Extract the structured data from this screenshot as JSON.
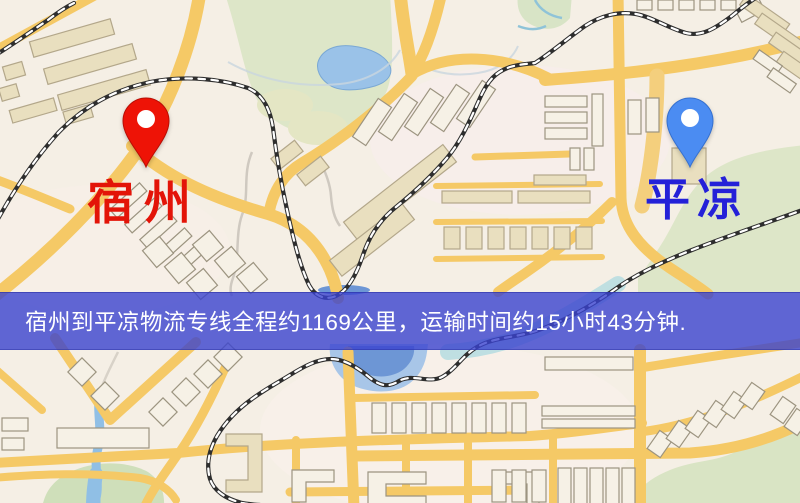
{
  "app": {
    "type": "logistics-route-map"
  },
  "markers": [
    {
      "name": "origin",
      "label": "宿州",
      "pin_color": "#ee1306",
      "label_color": "#e31408"
    },
    {
      "name": "destination",
      "label": "平凉",
      "pin_color": "#4b8cf2",
      "label_color": "#2421d8"
    }
  ],
  "banner": {
    "text": "宿州到平凉物流专线全程约1169公里，运输时间约15小时43分钟.",
    "bg_color": "#3942ce",
    "bg_opacity": 0.8,
    "text_color": "#ffffff"
  },
  "map_palette": {
    "base": "#f5efe5",
    "road": "#f5c966",
    "green": "#dde6c8",
    "water": "#9ac2e8",
    "lake_deep": "#6d96d5",
    "railway": "#2e2e2e",
    "building": "#e9dfbf"
  }
}
